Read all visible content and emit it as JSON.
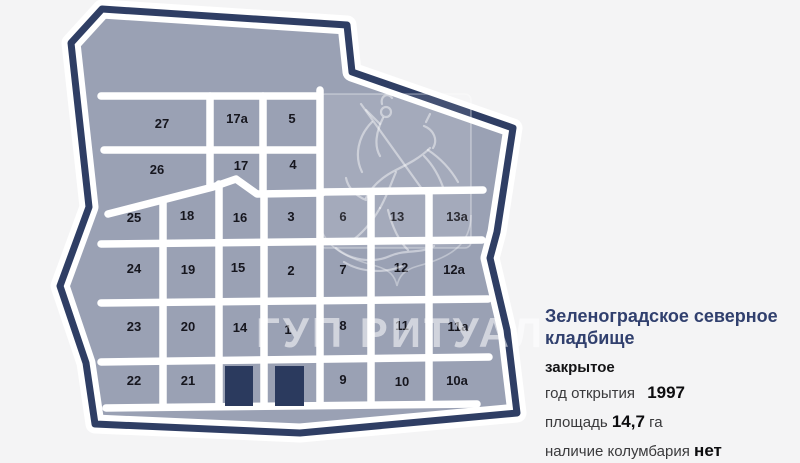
{
  "map": {
    "watermark_text": "ГУП РИТУАЛ",
    "colors": {
      "outline": "#2f3e64",
      "fill": "#9aa1b4",
      "roads": "#ffffff",
      "building": "#2b3a5e",
      "label": "#16161e"
    },
    "sections": [
      {
        "label": "27",
        "x": 162,
        "y": 128
      },
      {
        "label": "17а",
        "x": 237,
        "y": 123
      },
      {
        "label": "5",
        "x": 292,
        "y": 123
      },
      {
        "label": "26",
        "x": 157,
        "y": 174
      },
      {
        "label": "17",
        "x": 241,
        "y": 170
      },
      {
        "label": "4",
        "x": 293,
        "y": 169
      },
      {
        "label": "25",
        "x": 134,
        "y": 222
      },
      {
        "label": "18",
        "x": 187,
        "y": 220
      },
      {
        "label": "16",
        "x": 240,
        "y": 222
      },
      {
        "label": "3",
        "x": 291,
        "y": 221
      },
      {
        "label": "6",
        "x": 343,
        "y": 221
      },
      {
        "label": "13",
        "x": 397,
        "y": 221
      },
      {
        "label": "13а",
        "x": 457,
        "y": 221
      },
      {
        "label": "24",
        "x": 134,
        "y": 273
      },
      {
        "label": "19",
        "x": 188,
        "y": 274
      },
      {
        "label": "15",
        "x": 238,
        "y": 272
      },
      {
        "label": "2",
        "x": 291,
        "y": 275
      },
      {
        "label": "7",
        "x": 343,
        "y": 274
      },
      {
        "label": "12",
        "x": 401,
        "y": 272
      },
      {
        "label": "12а",
        "x": 454,
        "y": 274
      },
      {
        "label": "23",
        "x": 134,
        "y": 331
      },
      {
        "label": "20",
        "x": 188,
        "y": 331
      },
      {
        "label": "14",
        "x": 240,
        "y": 332
      },
      {
        "label": "1",
        "x": 288,
        "y": 334
      },
      {
        "label": "8",
        "x": 343,
        "y": 330
      },
      {
        "label": "11",
        "x": 402,
        "y": 330
      },
      {
        "label": "11а",
        "x": 458,
        "y": 331
      },
      {
        "label": "22",
        "x": 134,
        "y": 385
      },
      {
        "label": "21",
        "x": 188,
        "y": 385
      },
      {
        "label": "9",
        "x": 343,
        "y": 384
      },
      {
        "label": "10",
        "x": 402,
        "y": 386
      },
      {
        "label": "10а",
        "x": 457,
        "y": 385
      }
    ],
    "buildings": [
      {
        "x": 225,
        "y": 366,
        "w": 28,
        "h": 40
      },
      {
        "x": 275,
        "y": 366,
        "w": 29,
        "h": 40
      }
    ]
  },
  "info": {
    "title": "Зеленоградское северное кладбище",
    "status": "закрытое",
    "accent_color": "#31406e",
    "facts": [
      {
        "label": "год открытия",
        "value": "1997",
        "suffix": ""
      },
      {
        "label": "площадь",
        "value": "14,7",
        "suffix": "га"
      },
      {
        "label": "наличие колумбария",
        "value": "нет",
        "suffix": ""
      }
    ]
  }
}
